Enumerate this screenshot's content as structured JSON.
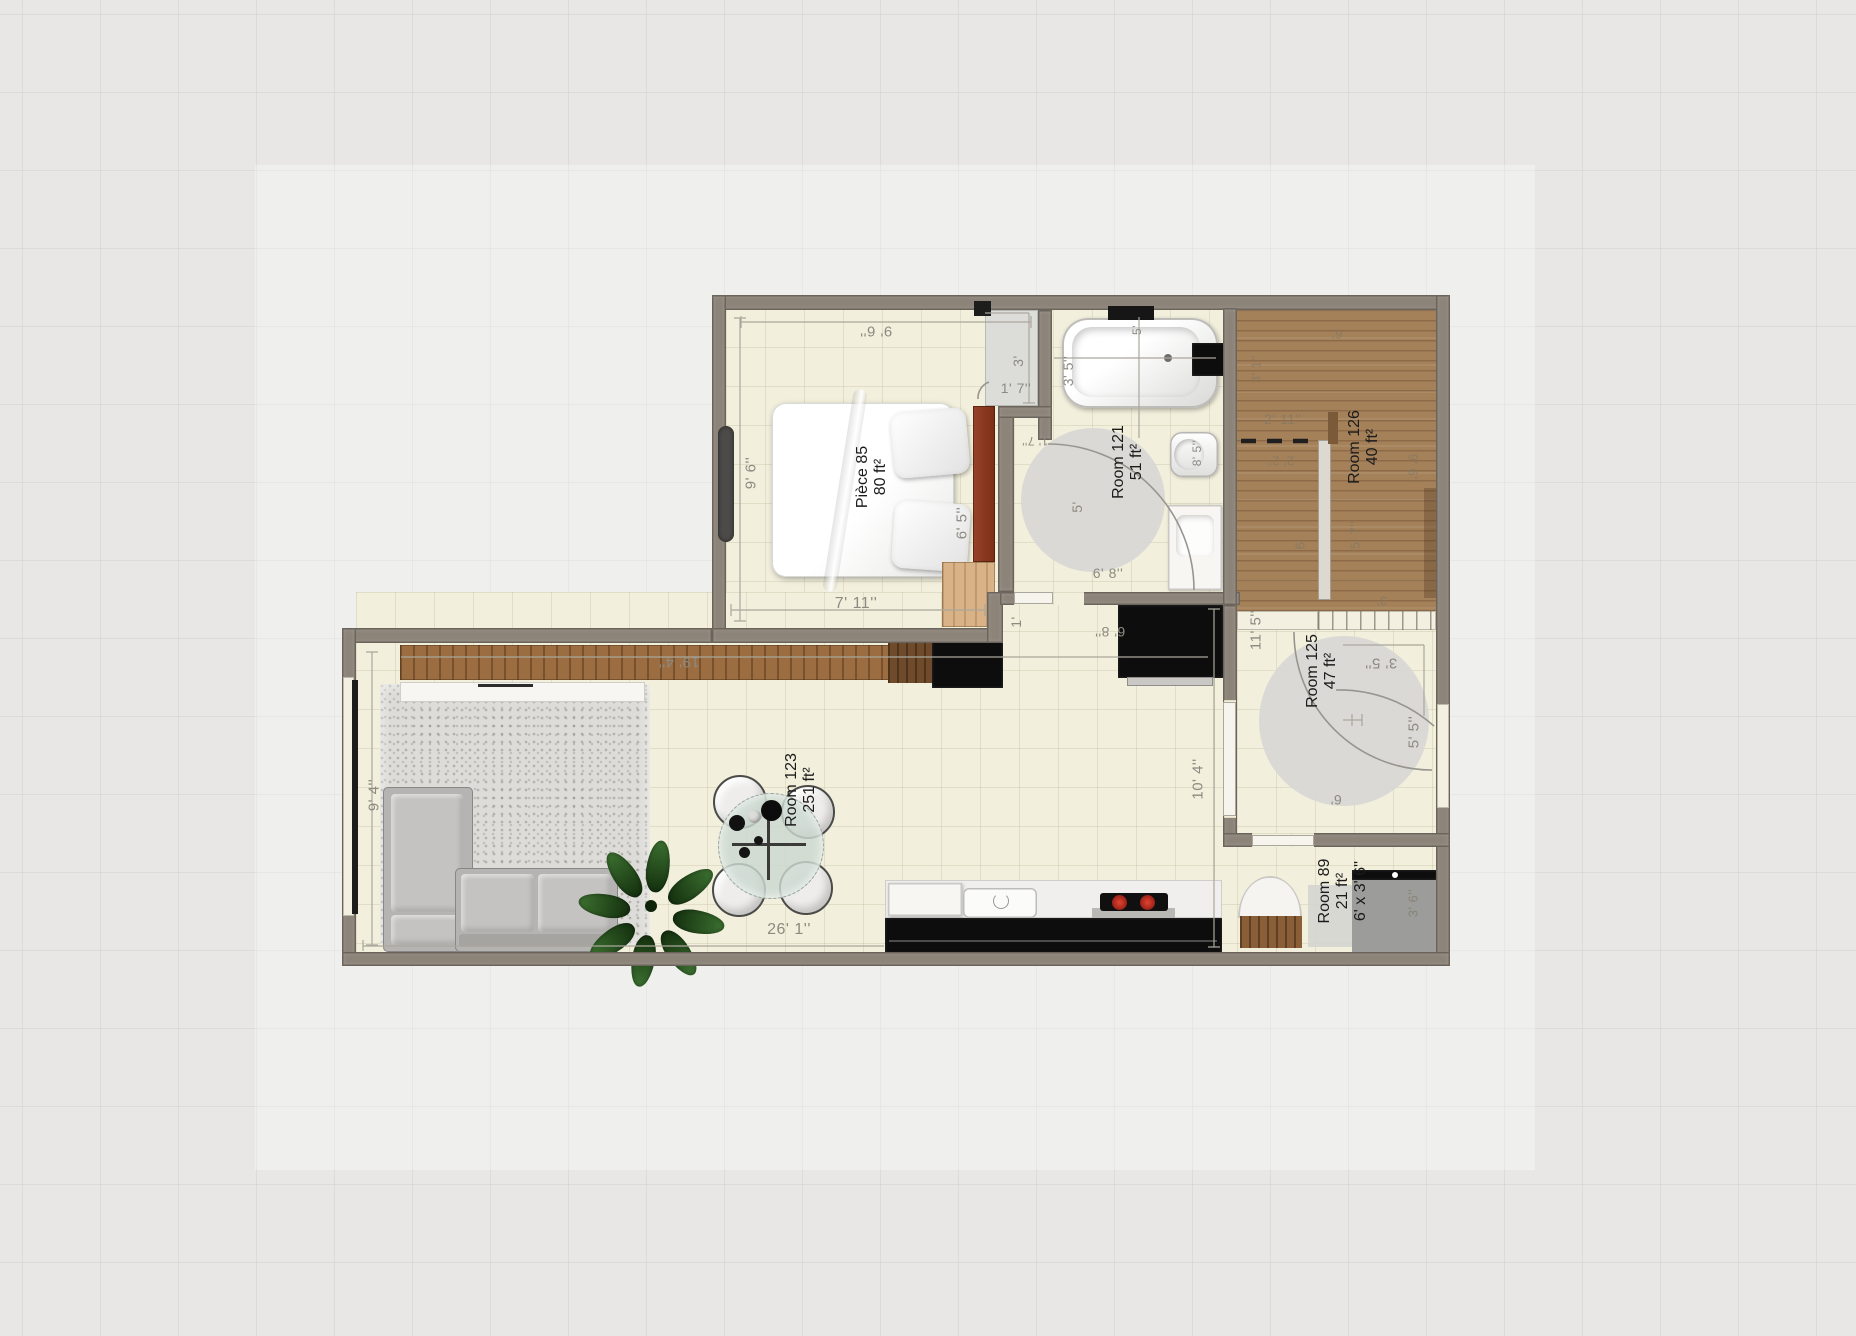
{
  "view": {
    "type": "floor-plan-2d",
    "units": "feet-inches"
  },
  "palette": {
    "canvas_bg": "#e8e7e5",
    "wall": "#8c8379",
    "floor": "#f2efdc",
    "wood_floor": "#a5815a",
    "cabinet_wood": "#9b6d40",
    "walnut": "#6f4b2b",
    "accent_tan": "#d9b287",
    "headboard_red": "#8c3a20",
    "counter_black": "#0d0d0d",
    "burner_red": "#c62f24",
    "dim_text": "#8d8a81"
  },
  "rooms": {
    "bedroom": {
      "name": "Pièce 85",
      "area": "80 ft²"
    },
    "bathroom": {
      "name": "Room 121",
      "area": "51 ft²"
    },
    "stairs": {
      "name": "Room 126",
      "area": "40 ft²"
    },
    "hall": {
      "name": "Room 125",
      "area": "47 ft²"
    },
    "wc": {
      "name": "Room 89",
      "area": "21 ft²",
      "size": "6' x 3' 6''"
    },
    "living": {
      "name": "Room 123",
      "area": "251 ft²"
    }
  },
  "dimension_labels": [
    {
      "text": "9' 6''",
      "x": 876,
      "y": 331,
      "rot": 180,
      "size": 15
    },
    {
      "text": "9' 6''",
      "x": 751,
      "y": 473,
      "rot": -90,
      "size": 15
    },
    {
      "text": "7' 11''",
      "x": 856,
      "y": 604,
      "rot": 0,
      "size": 16
    },
    {
      "text": "6' 5''",
      "x": 962,
      "y": 523,
      "rot": -90,
      "size": 15
    },
    {
      "text": "3'",
      "x": 1018,
      "y": 361,
      "rot": -90,
      "size": 14
    },
    {
      "text": "1' 7''",
      "x": 1016,
      "y": 388,
      "rot": 0,
      "size": 14
    },
    {
      "text": "3' 5''",
      "x": 1068,
      "y": 371,
      "rot": -90,
      "size": 14
    },
    {
      "text": "5'",
      "x": 1137,
      "y": 330,
      "rot": -90,
      "size": 12
    },
    {
      "text": "5'",
      "x": 1077,
      "y": 507,
      "rot": -90,
      "size": 14
    },
    {
      "text": "8' 5''",
      "x": 1197,
      "y": 453,
      "rot": -90,
      "size": 12
    },
    {
      "text": "1' 7''",
      "x": 1035,
      "y": 441,
      "rot": 180,
      "size": 12
    },
    {
      "text": "6' 8''",
      "x": 1108,
      "y": 573,
      "rot": 0,
      "size": 14
    },
    {
      "text": "6'",
      "x": 1337,
      "y": 334,
      "rot": 180,
      "size": 13,
      "faint": true
    },
    {
      "text": "3' 1''",
      "x": 1256,
      "y": 369,
      "rot": -90,
      "size": 13,
      "faint": true
    },
    {
      "text": "2' 11''",
      "x": 1283,
      "y": 419,
      "rot": 0,
      "size": 14,
      "faint": true
    },
    {
      "text": "2' 2''",
      "x": 1280,
      "y": 461,
      "rot": 180,
      "size": 13,
      "faint": true
    },
    {
      "text": "9' 6''",
      "x": 1413,
      "y": 468,
      "rot": 90,
      "size": 13,
      "faint": true
    },
    {
      "text": "5' 7''",
      "x": 1355,
      "y": 535,
      "rot": -90,
      "size": 13,
      "faint": true
    },
    {
      "text": "6'",
      "x": 1300,
      "y": 544,
      "rot": -90,
      "size": 13,
      "faint": true
    },
    {
      "text": "3'",
      "x": 1382,
      "y": 601,
      "rot": 180,
      "size": 13,
      "faint": true
    },
    {
      "text": "11' 5''",
      "x": 1256,
      "y": 630,
      "rot": -90,
      "size": 15
    },
    {
      "text": "3' 5''",
      "x": 1381,
      "y": 663,
      "rot": 180,
      "size": 15
    },
    {
      "text": "5' 5''",
      "x": 1414,
      "y": 732,
      "rot": -90,
      "size": 15
    },
    {
      "text": "6'",
      "x": 1336,
      "y": 800,
      "rot": 180,
      "size": 14
    },
    {
      "text": "3' 6''",
      "x": 1413,
      "y": 903,
      "rot": -90,
      "size": 13,
      "faint": true
    },
    {
      "text": "19' 4''",
      "x": 679,
      "y": 662,
      "rot": 180,
      "size": 15
    },
    {
      "text": "9' 4''",
      "x": 374,
      "y": 795,
      "rot": -90,
      "size": 15
    },
    {
      "text": "26' 1''",
      "x": 789,
      "y": 930,
      "rot": 0,
      "size": 16
    },
    {
      "text": "10' 4''",
      "x": 1198,
      "y": 779,
      "rot": -90,
      "size": 15
    },
    {
      "text": "1'",
      "x": 1016,
      "y": 622,
      "rot": -90,
      "size": 14
    },
    {
      "text": "6' 8''",
      "x": 1110,
      "y": 632,
      "rot": 180,
      "size": 14
    }
  ]
}
